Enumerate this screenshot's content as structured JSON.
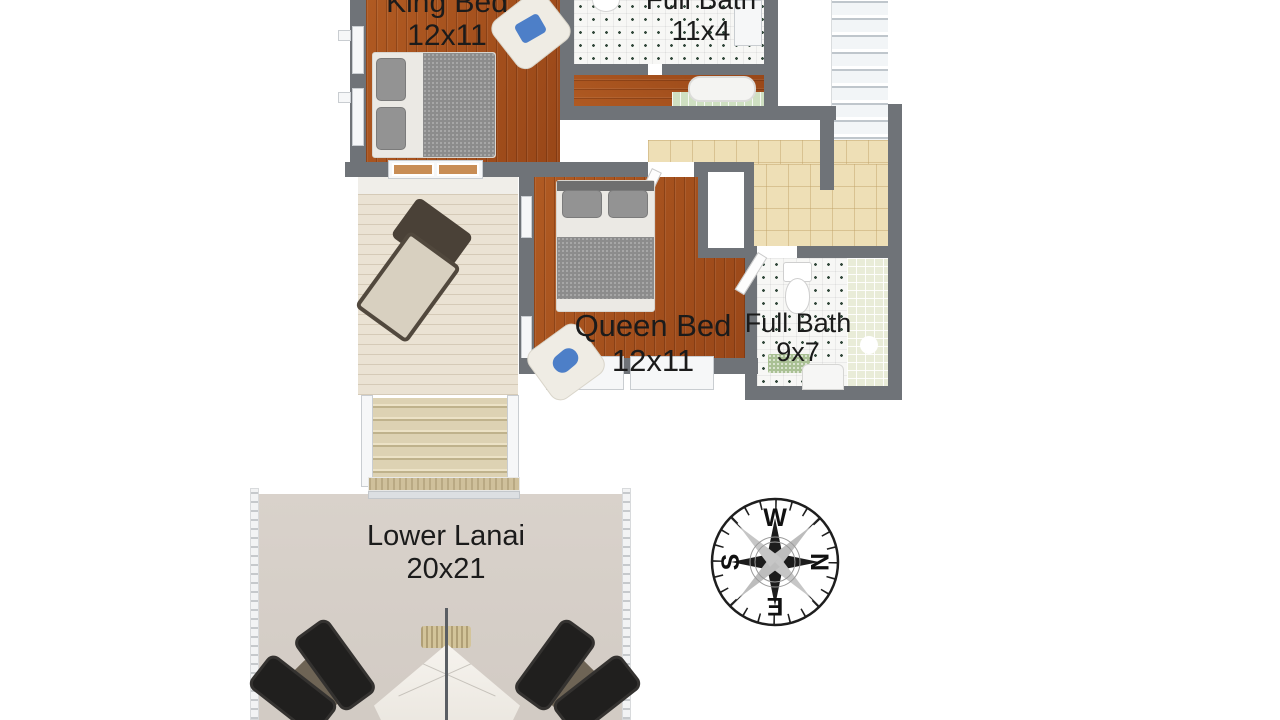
{
  "plan": {
    "type": "3d-floor-plan",
    "rooms": {
      "king_bed": {
        "label": "King Bed",
        "dimensions": "12x11"
      },
      "full_bath_upper": {
        "label": "Full Bath",
        "dimensions": "11x4"
      },
      "queen_bed": {
        "label": "Queen Bed",
        "dimensions": "12x11"
      },
      "full_bath_lower": {
        "label": "Full Bath",
        "dimensions": "9x7"
      },
      "lower_lanai": {
        "label": "Lower Lanai",
        "dimensions": "20x21"
      }
    },
    "compass": {
      "top": "W",
      "right": "N",
      "bottom": "E",
      "left": "S"
    },
    "colors": {
      "wall_gray": "#6f7378",
      "wood_floor": "#a3511e",
      "beige_tile": "#eedfb6",
      "bath_tile": "#f7f7f5",
      "deck_plank": "#eae2d3",
      "lanai_floor": "#d4cdc6",
      "pillow_blue": "#4d7fc8",
      "background": "#ffffff",
      "text": "#1b1b1b"
    }
  }
}
